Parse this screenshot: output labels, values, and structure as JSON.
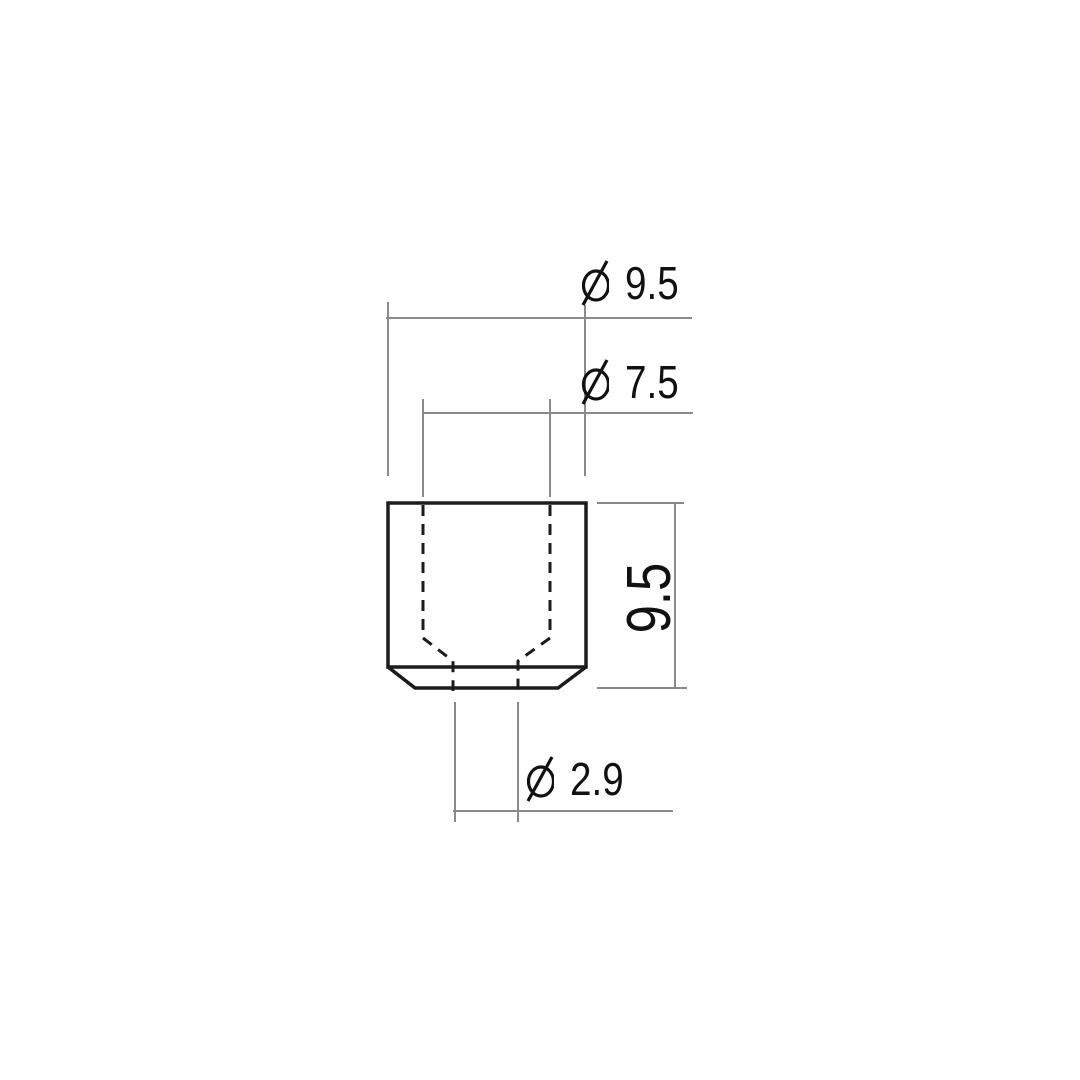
{
  "drawing": {
    "type": "technical-dimension-drawing",
    "subject": "bushing cross-section (cup-shaped part with stepped through-hole, chamfered bottom)",
    "labels": {
      "outer_diameter": {
        "symbol": "⌀",
        "value": "9.5"
      },
      "bore_diameter": {
        "symbol": "⌀",
        "value": "7.5"
      },
      "height": {
        "value": "9.5"
      },
      "stem_diameter": {
        "symbol": "⌀",
        "value": "2.9"
      }
    },
    "colors": {
      "background": "#ffffff",
      "outline": "#1c1c1c",
      "hidden_line": "#1c1c1c",
      "dimension_line": "#8a8a8a",
      "text": "#111111"
    }
  }
}
